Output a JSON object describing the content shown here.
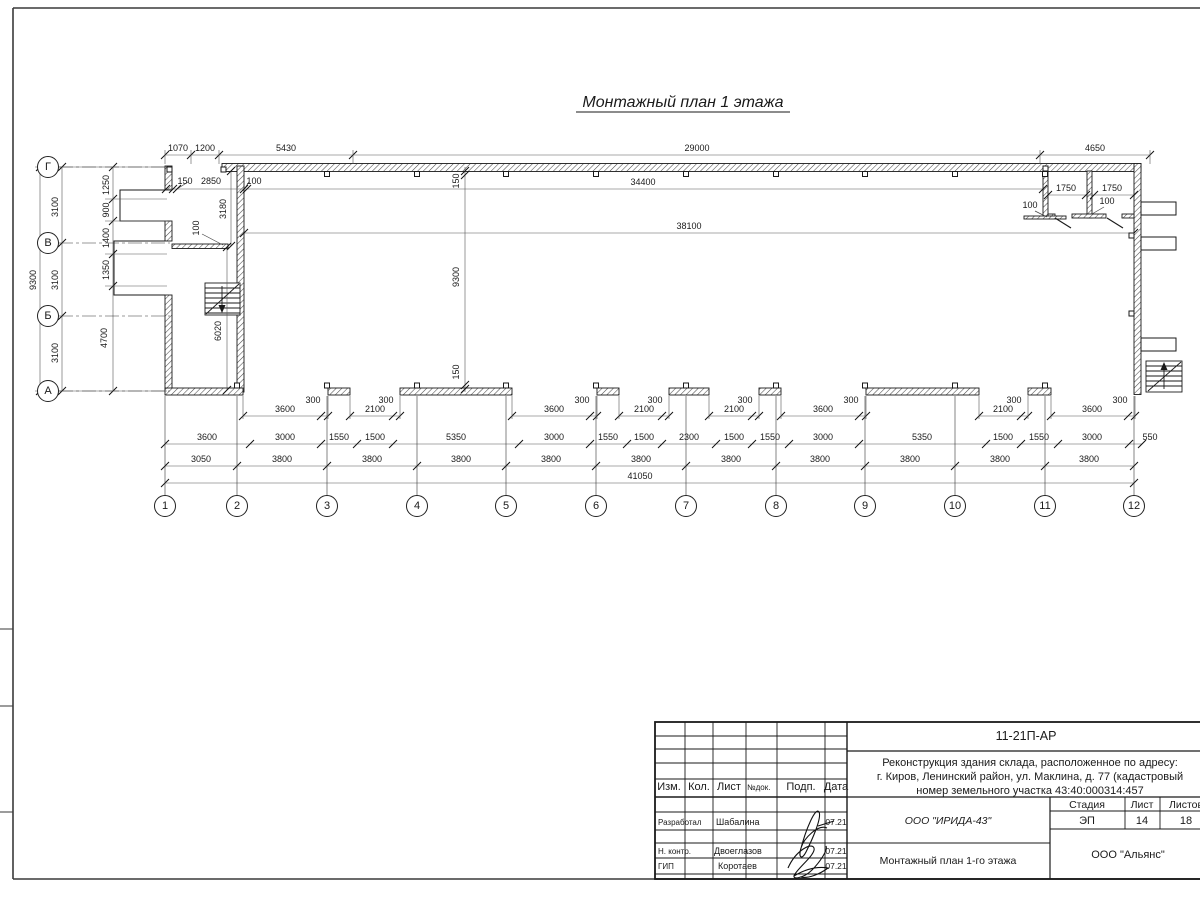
{
  "sheet": {
    "title": "Монтажный план 1 этажа"
  },
  "axes": {
    "rows": [
      {
        "label": "Г",
        "y": 167
      },
      {
        "label": "В",
        "y": 243
      },
      {
        "label": "Б",
        "y": 316
      },
      {
        "label": "А",
        "y": 391
      }
    ],
    "cols": [
      {
        "label": "1",
        "x": 165
      },
      {
        "label": "2",
        "x": 237
      },
      {
        "label": "3",
        "x": 327
      },
      {
        "label": "4",
        "x": 417
      },
      {
        "label": "5",
        "x": 506
      },
      {
        "label": "6",
        "x": 596
      },
      {
        "label": "7",
        "x": 686
      },
      {
        "label": "8",
        "x": 776
      },
      {
        "label": "9",
        "x": 865
      },
      {
        "label": "10",
        "x": 955
      },
      {
        "label": "11",
        "x": 1045
      },
      {
        "label": "12",
        "x": 1134
      }
    ]
  },
  "dims": [
    {
      "t": "1070",
      "x": 178,
      "y": 151
    },
    {
      "t": "1200",
      "x": 205,
      "y": 151
    },
    {
      "t": "5430",
      "x": 286,
      "y": 151
    },
    {
      "t": "29000",
      "x": 697,
      "y": 151
    },
    {
      "t": "4650",
      "x": 1095,
      "y": 151
    },
    {
      "t": "150",
      "x": 185,
      "y": 184
    },
    {
      "t": "2850",
      "x": 211,
      "y": 184
    },
    {
      "t": "100",
      "x": 254,
      "y": 184
    },
    {
      "t": "34400",
      "x": 643,
      "y": 185
    },
    {
      "t": "38100",
      "x": 689,
      "y": 229
    },
    {
      "t": "3180",
      "x": 226,
      "y": 209,
      "r": 1
    },
    {
      "t": "100",
      "x": 199,
      "y": 228,
      "r": 1
    },
    {
      "t": "150",
      "x": 459,
      "y": 181,
      "r": 1
    },
    {
      "t": "9300",
      "x": 459,
      "y": 277,
      "r": 1
    },
    {
      "t": "150",
      "x": 459,
      "y": 372,
      "r": 1
    },
    {
      "t": "6020",
      "x": 221,
      "y": 331,
      "r": 1
    },
    {
      "t": "1750",
      "x": 1066,
      "y": 191
    },
    {
      "t": "1750",
      "x": 1112,
      "y": 191
    },
    {
      "t": "100",
      "x": 1030,
      "y": 208
    },
    {
      "t": "100",
      "x": 1107,
      "y": 204
    },
    {
      "t": "9300",
      "x": 36,
      "y": 280,
      "r": 1
    },
    {
      "t": "3100",
      "x": 58,
      "y": 207,
      "r": 1
    },
    {
      "t": "3100",
      "x": 58,
      "y": 280,
      "r": 1
    },
    {
      "t": "3100",
      "x": 58,
      "y": 353,
      "r": 1
    },
    {
      "t": "1250",
      "x": 109,
      "y": 185,
      "r": 1
    },
    {
      "t": "900",
      "x": 109,
      "y": 210,
      "r": 1
    },
    {
      "t": "1400",
      "x": 109,
      "y": 238,
      "r": 1
    },
    {
      "t": "1350",
      "x": 109,
      "y": 270,
      "r": 1
    },
    {
      "t": "4700",
      "x": 107,
      "y": 338,
      "r": 1
    },
    {
      "t": "3600",
      "x": 285,
      "y": 412
    },
    {
      "t": "300",
      "x": 313,
      "y": 403
    },
    {
      "t": "2100",
      "x": 375,
      "y": 412
    },
    {
      "t": "300",
      "x": 386,
      "y": 403
    },
    {
      "t": "3600",
      "x": 554,
      "y": 412
    },
    {
      "t": "300",
      "x": 582,
      "y": 403
    },
    {
      "t": "2100",
      "x": 644,
      "y": 412
    },
    {
      "t": "300",
      "x": 655,
      "y": 403
    },
    {
      "t": "2100",
      "x": 734,
      "y": 412
    },
    {
      "t": "300",
      "x": 745,
      "y": 403
    },
    {
      "t": "3600",
      "x": 823,
      "y": 412
    },
    {
      "t": "300",
      "x": 851,
      "y": 403
    },
    {
      "t": "2100",
      "x": 1003,
      "y": 412
    },
    {
      "t": "300",
      "x": 1014,
      "y": 403
    },
    {
      "t": "3600",
      "x": 1092,
      "y": 412
    },
    {
      "t": "300",
      "x": 1120,
      "y": 403
    },
    {
      "t": "3600",
      "x": 207,
      "y": 440
    },
    {
      "t": "3000",
      "x": 285,
      "y": 440
    },
    {
      "t": "1550",
      "x": 339,
      "y": 440
    },
    {
      "t": "1500",
      "x": 375,
      "y": 440
    },
    {
      "t": "5350",
      "x": 456,
      "y": 440
    },
    {
      "t": "3000",
      "x": 554,
      "y": 440
    },
    {
      "t": "1550",
      "x": 608,
      "y": 440
    },
    {
      "t": "1500",
      "x": 644,
      "y": 440
    },
    {
      "t": "2300",
      "x": 689,
      "y": 440
    },
    {
      "t": "1500",
      "x": 734,
      "y": 440
    },
    {
      "t": "1550",
      "x": 770,
      "y": 440
    },
    {
      "t": "3000",
      "x": 823,
      "y": 440
    },
    {
      "t": "5350",
      "x": 922,
      "y": 440
    },
    {
      "t": "1500",
      "x": 1003,
      "y": 440
    },
    {
      "t": "1550",
      "x": 1039,
      "y": 440
    },
    {
      "t": "3000",
      "x": 1092,
      "y": 440
    },
    {
      "t": "550",
      "x": 1150,
      "y": 440
    },
    {
      "t": "3050",
      "x": 201,
      "y": 462
    },
    {
      "t": "3800",
      "x": 282,
      "y": 462
    },
    {
      "t": "3800",
      "x": 372,
      "y": 462
    },
    {
      "t": "3800",
      "x": 461,
      "y": 462
    },
    {
      "t": "3800",
      "x": 551,
      "y": 462
    },
    {
      "t": "3800",
      "x": 641,
      "y": 462
    },
    {
      "t": "3800",
      "x": 731,
      "y": 462
    },
    {
      "t": "3800",
      "x": 820,
      "y": 462
    },
    {
      "t": "3800",
      "x": 910,
      "y": 462
    },
    {
      "t": "3800",
      "x": 1000,
      "y": 462
    },
    {
      "t": "3800",
      "x": 1089,
      "y": 462
    },
    {
      "t": "41050",
      "x": 640,
      "y": 479
    }
  ],
  "title_block": {
    "code": "11-21П-АР",
    "desc_line1": "Реконструкция здания склада, расположенное по адресу:",
    "desc_line2": "г. Киров, Ленинский район, ул. Маклина, д. 77 (кадастровый",
    "desc_line3": "номер земельного участка 43:40:000314:457",
    "header": {
      "izm": "Изм.",
      "kol": "Кол.",
      "list": "Лист",
      "ndok": "№док.",
      "podp": "Подп.",
      "data": "Дата"
    },
    "row1_role": "Разработал",
    "row1_name": "Шабалина",
    "row1_date": "07.21",
    "row2_role": "Н. контр.",
    "row2_name": "Двоеглазов",
    "row2_date": "07.21",
    "row3_role": "ГИП",
    "row3_name": "Коротаев",
    "row3_date": "07.21",
    "org": "ООО \"ИРИДА-43\"",
    "stage_label": "Стадия",
    "sheet_label": "Лист",
    "sheets_label": "Листов",
    "stage": "ЭП",
    "sheet_no": "14",
    "sheets_total": "18",
    "drawing_name": "Монтажный план 1-го этажа",
    "company": "ООО \"Альянс\""
  }
}
